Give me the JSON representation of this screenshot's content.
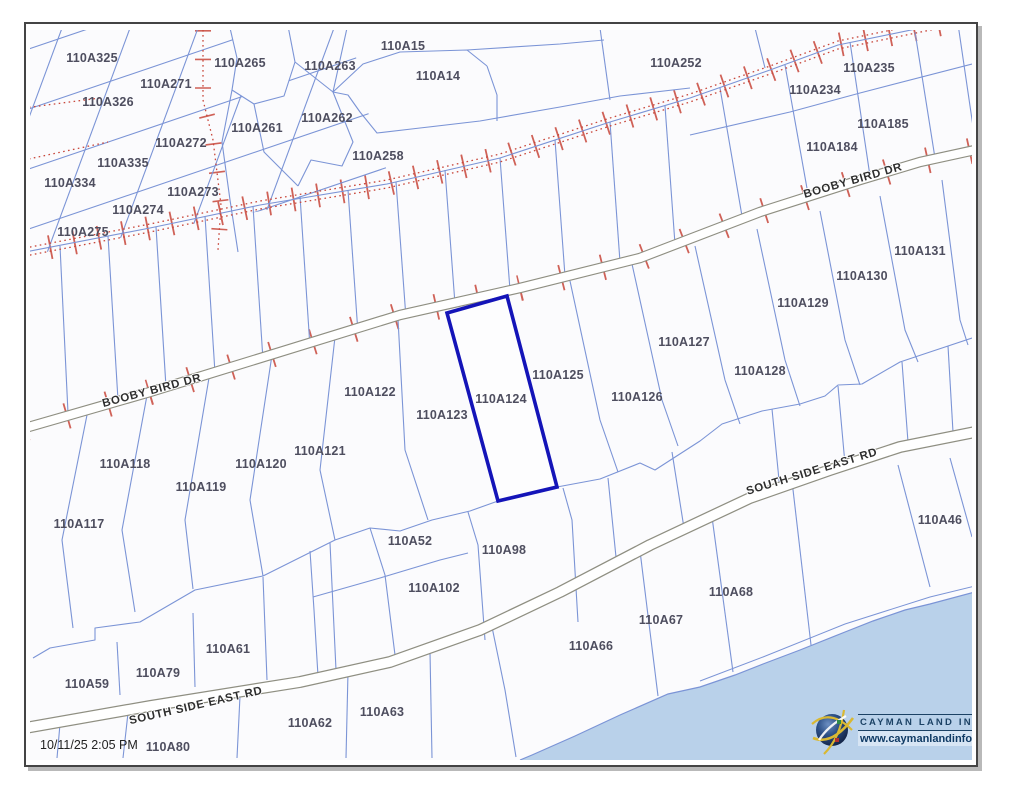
{
  "map": {
    "timestamp": "10/11/25 2:05 PM",
    "selected_parcel_id": "110A124",
    "colors": {
      "parcel_line": "#7b94d6",
      "selected_outline": "#1414b8",
      "road_casing": "#8f8f82",
      "road_fill": "#ffffff",
      "corridor_red": "#c8473b",
      "water": "#b9d1ea",
      "label_text": "#4e4e5f",
      "road_label_text": "#2e2e2e"
    },
    "road_labels": [
      {
        "name": "BOOBY BIRD DR",
        "x": 152,
        "y": 391,
        "angle": -15
      },
      {
        "name": "BOOBY BIRD DR",
        "x": 853,
        "y": 181,
        "angle": -16
      },
      {
        "name": "SOUTH SIDE EAST RD",
        "x": 812,
        "y": 472,
        "angle": -17
      },
      {
        "name": "SOUTH SIDE EAST RD",
        "x": 196,
        "y": 706,
        "angle": -13
      }
    ],
    "parcel_labels": [
      {
        "id": "110A325",
        "x": 92,
        "y": 58
      },
      {
        "id": "110A265",
        "x": 240,
        "y": 63
      },
      {
        "id": "110A263",
        "x": 330,
        "y": 66
      },
      {
        "id": "110A271",
        "x": 166,
        "y": 84
      },
      {
        "id": "110A326",
        "x": 108,
        "y": 102
      },
      {
        "id": "110A262",
        "x": 327,
        "y": 118
      },
      {
        "id": "110A261",
        "x": 257,
        "y": 128
      },
      {
        "id": "110A272",
        "x": 181,
        "y": 143
      },
      {
        "id": "110A335",
        "x": 123,
        "y": 163
      },
      {
        "id": "110A334",
        "x": 70,
        "y": 183
      },
      {
        "id": "110A273",
        "x": 193,
        "y": 192
      },
      {
        "id": "110A274",
        "x": 138,
        "y": 210
      },
      {
        "id": "110A275",
        "x": 83,
        "y": 232
      },
      {
        "id": "110A15",
        "x": 403,
        "y": 46
      },
      {
        "id": "110A14",
        "x": 438,
        "y": 76
      },
      {
        "id": "110A258",
        "x": 378,
        "y": 156
      },
      {
        "id": "110A252",
        "x": 676,
        "y": 63
      },
      {
        "id": "110A235",
        "x": 869,
        "y": 68
      },
      {
        "id": "110A234",
        "x": 815,
        "y": 90
      },
      {
        "id": "110A185",
        "x": 883,
        "y": 124
      },
      {
        "id": "110A184",
        "x": 832,
        "y": 147
      },
      {
        "id": "110A131",
        "x": 920,
        "y": 251
      },
      {
        "id": "110A130",
        "x": 862,
        "y": 276
      },
      {
        "id": "110A129",
        "x": 803,
        "y": 303
      },
      {
        "id": "110A128",
        "x": 760,
        "y": 371
      },
      {
        "id": "110A127",
        "x": 684,
        "y": 342
      },
      {
        "id": "110A126",
        "x": 637,
        "y": 397
      },
      {
        "id": "110A125",
        "x": 558,
        "y": 375
      },
      {
        "id": "110A124",
        "x": 501,
        "y": 399,
        "selected": true
      },
      {
        "id": "110A123",
        "x": 442,
        "y": 415
      },
      {
        "id": "110A122",
        "x": 370,
        "y": 392
      },
      {
        "id": "110A121",
        "x": 320,
        "y": 451
      },
      {
        "id": "110A120",
        "x": 261,
        "y": 464
      },
      {
        "id": "110A119",
        "x": 201,
        "y": 487
      },
      {
        "id": "110A118",
        "x": 125,
        "y": 464
      },
      {
        "id": "110A117",
        "x": 79,
        "y": 524
      },
      {
        "id": "110A52",
        "x": 410,
        "y": 541
      },
      {
        "id": "110A98",
        "x": 504,
        "y": 550
      },
      {
        "id": "110A102",
        "x": 434,
        "y": 588
      },
      {
        "id": "110A46",
        "x": 940,
        "y": 520
      },
      {
        "id": "110A68",
        "x": 731,
        "y": 592
      },
      {
        "id": "110A67",
        "x": 661,
        "y": 620
      },
      {
        "id": "110A66",
        "x": 591,
        "y": 646
      },
      {
        "id": "110A61",
        "x": 228,
        "y": 649
      },
      {
        "id": "110A79",
        "x": 158,
        "y": 673
      },
      {
        "id": "110A59",
        "x": 87,
        "y": 684
      },
      {
        "id": "110A63",
        "x": 382,
        "y": 712
      },
      {
        "id": "110A62",
        "x": 310,
        "y": 723
      },
      {
        "id": "110A80",
        "x": 168,
        "y": 747
      }
    ]
  },
  "branding": {
    "name": "CAYMAN LAND INFO",
    "url": "www.caymanlandinfo.ky",
    "logo_icon": "globe-logo-icon"
  }
}
